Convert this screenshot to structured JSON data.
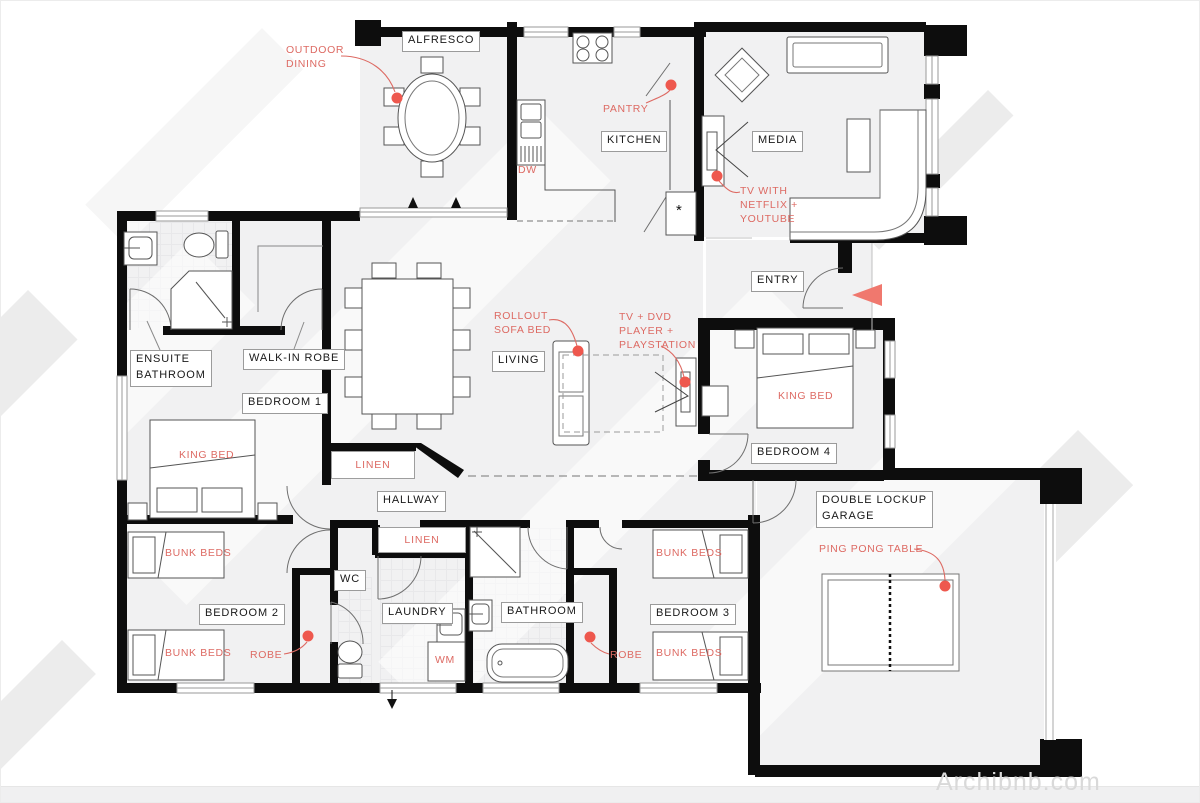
{
  "watermark": "Archibnb.com",
  "colors": {
    "annotation_red": "#dd6a63",
    "dot_red": "#ee584e",
    "entry_arrow_red": "#f0786e",
    "wall_black": "#0d0d0d",
    "room_fill": "#f1f1f2",
    "label_border": "#9b9b9b"
  },
  "room_labels": {
    "alfresco": "ALFRESCO",
    "kitchen": "KITCHEN",
    "media": "MEDIA",
    "entry": "ENTRY",
    "living": "LIVING",
    "hallway": "HALLWAY",
    "ensuite_bathroom": "ENSUITE\nBATHROOM",
    "walk_in_robe": "WALK-IN ROBE",
    "bedroom_1": "BEDROOM 1",
    "bedroom_2": "BEDROOM 2",
    "bedroom_3": "BEDROOM 3",
    "bedroom_4": "BEDROOM 4",
    "wc": "WC",
    "laundry": "LAUNDRY",
    "bathroom": "BATHROOM",
    "garage": "DOUBLE LOCKUP\nGARAGE"
  },
  "annotations": {
    "outdoor_dining": "OUTDOOR\nDINING",
    "pantry": "PANTRY",
    "dishwasher": "DW",
    "tv_netflix": "TV WITH\nNETFLIX +\nYOUTUBE",
    "rollout_sofa_bed": "ROLLOUT\nSOFA BED",
    "tv_dvd_playstation": "TV + DVD\nPLAYER +\nPLAYSTATION",
    "king_bed_bedroom_1": "KING BED",
    "king_bed_bedroom_4": "KING BED",
    "bunk_beds_bedroom_2_top": "BUNK BEDS",
    "bunk_beds_bedroom_2_bottom": "BUNK BEDS",
    "bunk_beds_bedroom_3_top": "BUNK BEDS",
    "bunk_beds_bedroom_3_bottom": "BUNK BEDS",
    "robe_bedroom_2": "ROBE",
    "robe_bedroom_3": "ROBE",
    "washing_machine": "WM",
    "ping_pong_table": "PING PONG TABLE",
    "linen_hall": "LINEN",
    "linen_laundry": "LINEN",
    "fridge_symbol": "*"
  }
}
